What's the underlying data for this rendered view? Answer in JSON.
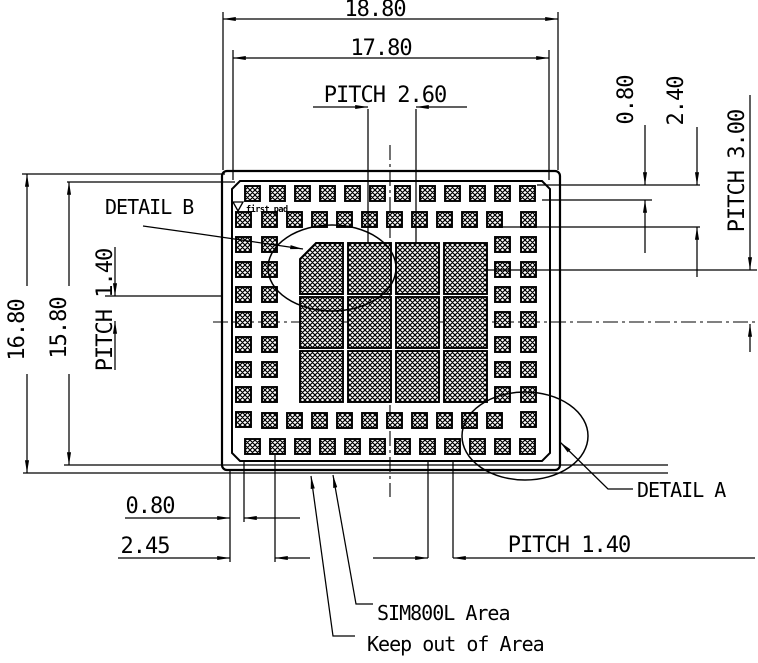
{
  "colors": {
    "ink": "#000000",
    "paper": "#ffffff"
  },
  "dimensions": {
    "outer_width": "18.80",
    "inner_width": "17.80",
    "center_pitch_x": "PITCH 2.60",
    "pad_height": "0.80",
    "double_row_span": "2.40",
    "center_pitch_y": "PITCH 3.00",
    "outer_height": "16.80",
    "inner_height": "15.80",
    "side_pad_pitch": "PITCH 1.40",
    "bottom_pad_offset": "0.80",
    "bottom_corner_offset": "2.45",
    "bottom_pad_pitch": "PITCH 1.40"
  },
  "labels": {
    "detail_b": "DETAIL B",
    "detail_a": "DETAIL A",
    "module_area": "SIM800L Area",
    "keep_out": "Keep out of Area",
    "first_pad": "first pad"
  },
  "footprint": {
    "pad_small": {
      "w": 15,
      "h": 15
    },
    "groups": [
      {
        "name": "top-outer-row",
        "x": 245,
        "y": 186,
        "count": 12,
        "dx": 25,
        "dy": 0
      },
      {
        "name": "bottom-outer-row",
        "x": 245,
        "y": 439,
        "count": 12,
        "dx": 25,
        "dy": 0
      },
      {
        "name": "top-inner-row",
        "x": 262,
        "y": 212,
        "count": 10,
        "dx": 25,
        "dy": 0
      },
      {
        "name": "bottom-inner-row",
        "x": 262,
        "y": 413,
        "count": 10,
        "dx": 25,
        "dy": 0
      },
      {
        "name": "left-outer-col",
        "x": 236,
        "y": 212,
        "count": 9,
        "dx": 0,
        "dy": 25
      },
      {
        "name": "right-outer-col",
        "x": 521,
        "y": 212,
        "count": 9,
        "dx": 0,
        "dy": 25
      },
      {
        "name": "left-inner-col",
        "x": 262,
        "y": 237,
        "count": 7,
        "dx": 0,
        "dy": 25
      },
      {
        "name": "right-inner-col",
        "x": 495,
        "y": 237,
        "count": 7,
        "dx": 0,
        "dy": 25
      }
    ],
    "big_pads": {
      "cols": [
        300,
        348,
        396,
        444
      ],
      "rows": [
        243,
        297,
        351
      ],
      "w": 43,
      "h": 51,
      "chamfer": 16
    }
  }
}
